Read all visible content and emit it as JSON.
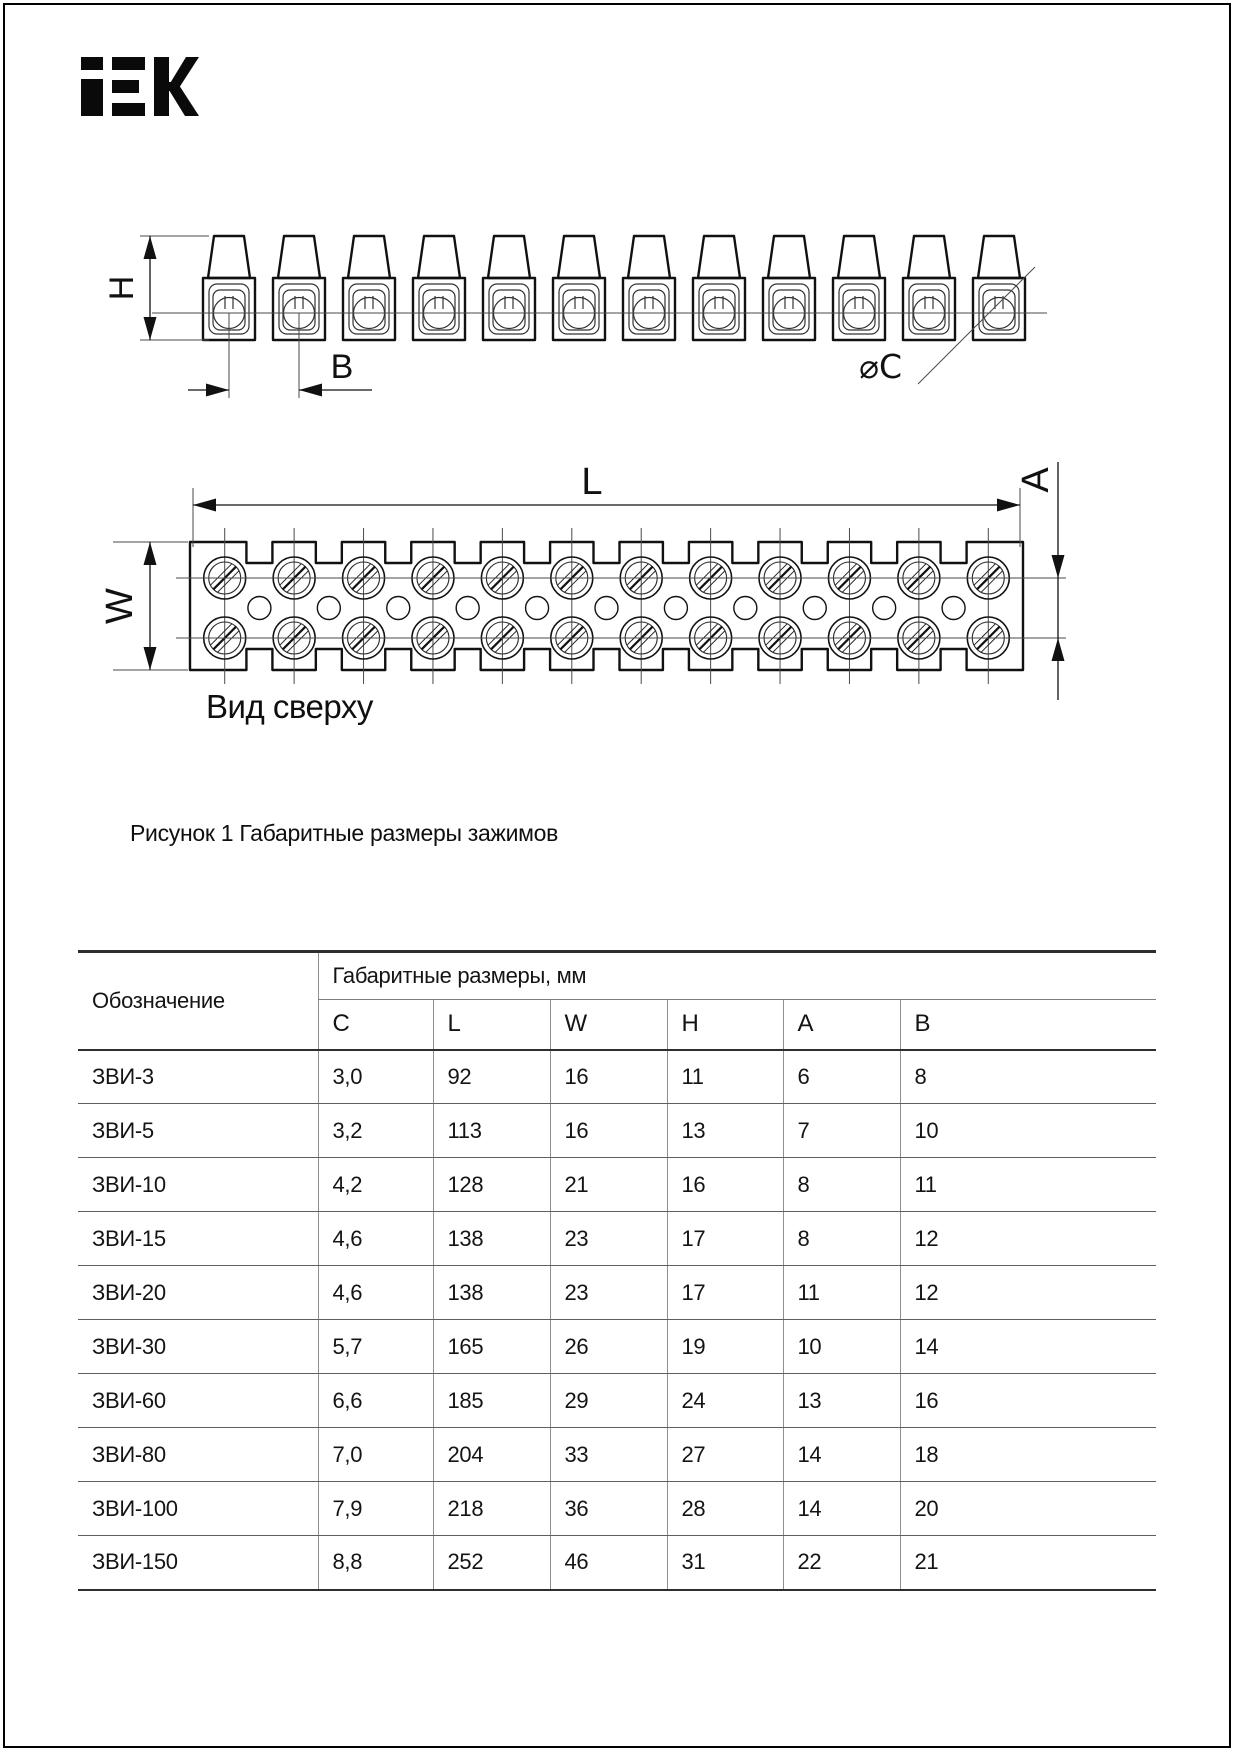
{
  "logo": {
    "name": "IEK",
    "color": "#0a0a0a"
  },
  "figure": {
    "side_view": {
      "cells": 12,
      "labels": {
        "h": "H",
        "b": "B",
        "dc": "⌀C"
      }
    },
    "top_view": {
      "columns": 12,
      "labels": {
        "l": "L",
        "a": "A",
        "w": "W"
      },
      "caption": "Вид сверху"
    },
    "caption": "Рисунок 1  Габаритные размеры зажимов"
  },
  "table": {
    "col1_header": "Обозначение",
    "group_header": "Габаритные размеры, мм",
    "dim_headers": [
      "C",
      "L",
      "W",
      "H",
      "A",
      "B"
    ],
    "rows": [
      {
        "name": "ЗВИ-3",
        "values": [
          "3,0",
          "92",
          "16",
          "11",
          "6",
          "8"
        ]
      },
      {
        "name": "ЗВИ-5",
        "values": [
          "3,2",
          "113",
          "16",
          "13",
          "7",
          "10"
        ]
      },
      {
        "name": "ЗВИ-10",
        "values": [
          "4,2",
          "128",
          "21",
          "16",
          "8",
          "11"
        ]
      },
      {
        "name": "ЗВИ-15",
        "values": [
          "4,6",
          "138",
          "23",
          "17",
          "8",
          "12"
        ]
      },
      {
        "name": "ЗВИ-20",
        "values": [
          "4,6",
          "138",
          "23",
          "17",
          "11",
          "12"
        ]
      },
      {
        "name": "ЗВИ-30",
        "values": [
          "5,7",
          "165",
          "26",
          "19",
          "10",
          "14"
        ]
      },
      {
        "name": "ЗВИ-60",
        "values": [
          "6,6",
          "185",
          "29",
          "24",
          "13",
          "16"
        ]
      },
      {
        "name": "ЗВИ-80",
        "values": [
          "7,0",
          "204",
          "33",
          "27",
          "14",
          "18"
        ]
      },
      {
        "name": "ЗВИ-100",
        "values": [
          "7,9",
          "218",
          "36",
          "28",
          "14",
          "20"
        ]
      },
      {
        "name": "ЗВИ-150",
        "values": [
          "8,8",
          "252",
          "46",
          "31",
          "22",
          "21"
        ]
      }
    ]
  }
}
